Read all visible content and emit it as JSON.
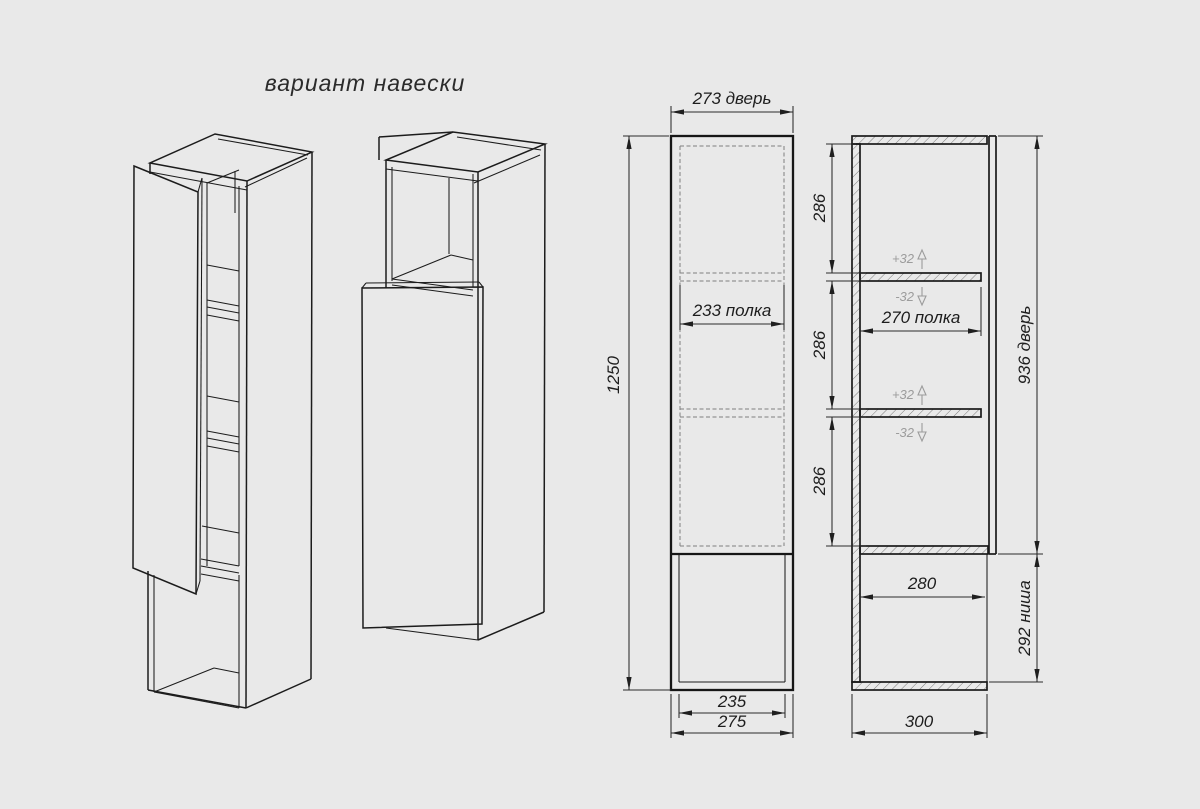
{
  "title": "вариант навески",
  "colors": {
    "background": "#e9e9e9",
    "line": "#1a1a1a",
    "dimension": "#2a2a2a",
    "hidden_dash": "#7f7f7f",
    "adjust_annotation": "#9c9c9c"
  },
  "front_view": {
    "dim_door_width": "273 дверь",
    "dim_height": "1250",
    "dim_shelf_width": "233 полка",
    "dim_niche_inner_width": "235",
    "dim_outer_width": "275"
  },
  "section_view": {
    "dim_section_1": "286",
    "dim_section_2": "286",
    "dim_section_3": "286",
    "dim_shelf_depth": "270 полка",
    "dim_door_height": "936 дверь",
    "dim_niche_depth": "280",
    "dim_niche_height": "292 ниша",
    "dim_outer_depth": "300",
    "shelf_adjust_up": "+32",
    "shelf_adjust_down": "-32"
  }
}
